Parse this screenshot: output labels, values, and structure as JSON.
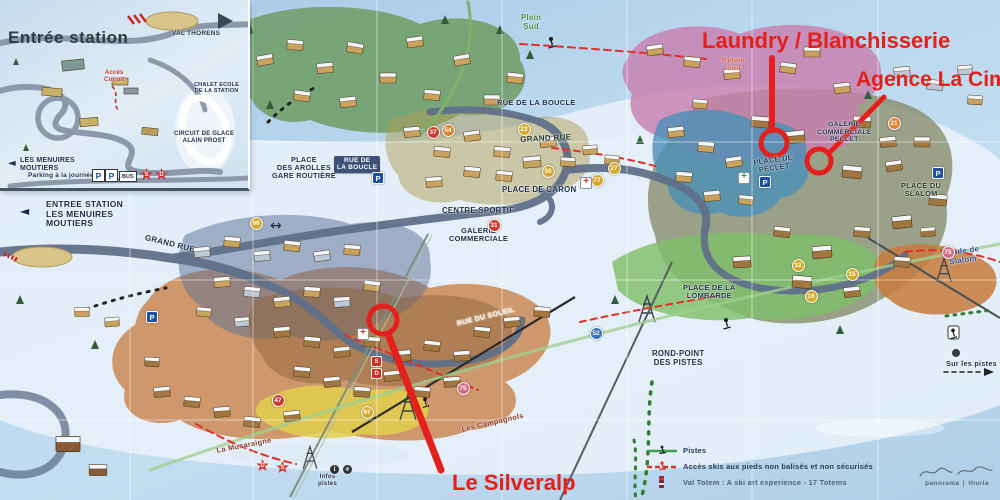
{
  "colors": {
    "annotation_red": "#e3201b",
    "navy_label": "#1c2b4a",
    "sky": "#aecfe8"
  },
  "annotations": {
    "laundry": {
      "label": "Laundry / Blanchisserie"
    },
    "agence": {
      "label": "Agence La Cime"
    },
    "silveralp": {
      "label": "Le Silveralp"
    }
  },
  "inset": {
    "title": "Entrée station",
    "destination": "VAL THORENS",
    "acces_circuit": "Accès\nCircuit",
    "chalet_ecole": "CHALET ECOLE\nDE LA STATION",
    "circuit_glace": "CIRCUIT DE GLACE\nALAIN PROST",
    "direction": "LES MENUIRES\nMOUTIERS",
    "parking_caption": "Parking à la journée",
    "parking_letter": "P",
    "bus": "BUS",
    "badges": [
      "S",
      "D"
    ]
  },
  "labels": [
    {
      "t": "ENTREE STATION\nLES MENUIRES\nMOUTIERS",
      "x": 46,
      "y": 200,
      "s": 8.5,
      "c": "#1c2b4a",
      "r": 0,
      "ta": "left"
    },
    {
      "t": "GRAND RUE",
      "x": 146,
      "y": 234,
      "s": 8,
      "c": "#1c2b4a",
      "r": 14
    },
    {
      "t": "GRAND RUE",
      "x": 520,
      "y": 136,
      "s": 8,
      "c": "#273522",
      "r": -3
    },
    {
      "t": "PLACE\nDES AROLLES\nGARE ROUTIÈRE",
      "x": 272,
      "y": 156,
      "s": 7.2,
      "c": "#1c2b4a",
      "r": 0
    },
    {
      "t": "RUE DE LA BOUCLE",
      "x": 497,
      "y": 99,
      "s": 7.5,
      "c": "#1c2b4a",
      "r": 0
    },
    {
      "t": "RUE DE\nLA BOUCLE",
      "x": 334,
      "y": 156,
      "s": 6.5,
      "c": "#ffffff",
      "r": 0,
      "bg": true
    },
    {
      "t": "PLACE DE CARON",
      "x": 502,
      "y": 186,
      "s": 7.8,
      "c": "#1c2b4a",
      "r": 0
    },
    {
      "t": "CENTRE SPORTIF",
      "x": 442,
      "y": 207,
      "s": 7.8,
      "c": "#1c2b4a",
      "r": 0
    },
    {
      "t": "GALERIE\nCOMMERCIALE",
      "x": 449,
      "y": 227,
      "s": 7.4,
      "c": "#1c2b4a",
      "r": 0
    },
    {
      "t": "GALERIE\nCOMMERCIALE\nPECLET",
      "x": 817,
      "y": 121,
      "s": 6.8,
      "c": "#1c2b4a",
      "r": 0
    },
    {
      "t": "PLACE DE\nPECLET",
      "x": 753,
      "y": 159,
      "s": 7.4,
      "c": "#16314b",
      "r": -8
    },
    {
      "t": "PLACE DU\nSLALOM",
      "x": 901,
      "y": 182,
      "s": 7.4,
      "c": "#2a3322",
      "r": 0
    },
    {
      "t": "Stade de\nSlalom",
      "x": 944,
      "y": 250,
      "s": 7.8,
      "c": "#2b4f93",
      "r": -8
    },
    {
      "t": "PLACE DE LA\nLOMBARDE",
      "x": 683,
      "y": 284,
      "s": 7.4,
      "c": "#1c2b4a",
      "r": 0
    },
    {
      "t": "ROND-POINT\nDES PISTES",
      "x": 652,
      "y": 350,
      "s": 7.8,
      "c": "#1c2b4a",
      "r": 0
    },
    {
      "t": "Plein\nSud",
      "x": 521,
      "y": 14,
      "s": 7.8,
      "c": "#3d8f44",
      "r": 0
    },
    {
      "t": "Retour\nSud",
      "x": 722,
      "y": 57,
      "s": 6.8,
      "c": "#d05225",
      "r": 0
    },
    {
      "t": "RUE DU SOLEIL",
      "x": 456,
      "y": 320,
      "s": 7.2,
      "c": "#f2ead6",
      "r": -14
    },
    {
      "t": "Les Campagnols",
      "x": 461,
      "y": 426,
      "s": 7.4,
      "c": "#8a3527",
      "r": -13
    },
    {
      "t": "La Musaraigne",
      "x": 216,
      "y": 447,
      "s": 7.4,
      "c": "#8a3527",
      "r": -11
    },
    {
      "t": "Sur les pistes",
      "x": 946,
      "y": 360,
      "s": 7.2,
      "c": "#1c2b4a",
      "r": 0
    },
    {
      "t": "Infos\npistes",
      "x": 318,
      "y": 474,
      "s": 6,
      "c": "#1c2b4a",
      "r": 0
    }
  ],
  "legend": {
    "items": [
      {
        "label": "Pistes"
      },
      {
        "label": "Accès skis aux pieds non balisés et non sécurisés"
      },
      {
        "label": "Val Totem : A ski art experience - 17 Totems"
      }
    ]
  },
  "credit": {
    "left": "panorama",
    "right": "thuria"
  },
  "markers": [
    {
      "n": "54",
      "x": 447,
      "y": 129,
      "c": "#e0812e"
    },
    {
      "n": "37",
      "x": 432,
      "y": 131,
      "c": "#cc3b2e"
    },
    {
      "n": "23",
      "x": 523,
      "y": 128,
      "c": "#d4a92c"
    },
    {
      "n": "50",
      "x": 547,
      "y": 170,
      "c": "#d4a92c"
    },
    {
      "n": "27",
      "x": 613,
      "y": 167,
      "c": "#d4a92c"
    },
    {
      "n": "77",
      "x": 596,
      "y": 179,
      "c": "#d4a92c"
    },
    {
      "n": "31",
      "x": 493,
      "y": 224,
      "c": "#cc3b2e"
    },
    {
      "n": "66",
      "x": 255,
      "y": 222,
      "c": "#d4a92c"
    },
    {
      "n": "21",
      "x": 893,
      "y": 122,
      "c": "#e0812e"
    },
    {
      "n": "12",
      "x": 797,
      "y": 264,
      "c": "#d4a92c"
    },
    {
      "n": "15",
      "x": 851,
      "y": 273,
      "c": "#d4a92c"
    },
    {
      "n": "16",
      "x": 810,
      "y": 295,
      "c": "#d4a92c"
    },
    {
      "n": "75",
      "x": 947,
      "y": 251,
      "c": "#d46a8a"
    },
    {
      "n": "75",
      "x": 462,
      "y": 387,
      "c": "#d46a8a"
    },
    {
      "n": "97",
      "x": 366,
      "y": 411,
      "c": "#d4a92c"
    },
    {
      "n": "47",
      "x": 277,
      "y": 399,
      "c": "#cc3b2e"
    },
    {
      "n": "52",
      "x": 595,
      "y": 332,
      "c": "#3a6fc0"
    }
  ],
  "icons": {
    "parkings": [
      {
        "x": 377,
        "y": 177
      },
      {
        "x": 151,
        "y": 316
      },
      {
        "x": 764,
        "y": 181
      },
      {
        "x": 937,
        "y": 172
      }
    ],
    "crosses": [
      {
        "x": 743,
        "y": 177,
        "color": "#2e9e3e"
      },
      {
        "x": 585,
        "y": 182,
        "color": "#d8342a"
      },
      {
        "x": 362,
        "y": 333,
        "color": "#d8342a"
      }
    ],
    "badges": [
      {
        "l": "S",
        "x": 371,
        "y": 356,
        "shape": "square"
      },
      {
        "l": "D",
        "x": 371,
        "y": 368,
        "shape": "square"
      },
      {
        "l": "D",
        "x": 256,
        "y": 459,
        "shape": "star"
      },
      {
        "l": "S",
        "x": 276,
        "y": 461,
        "shape": "star"
      }
    ],
    "dots": [
      {
        "x": 329,
        "y": 464,
        "t": "i"
      },
      {
        "x": 342,
        "y": 464,
        "t": "❄"
      }
    ]
  }
}
